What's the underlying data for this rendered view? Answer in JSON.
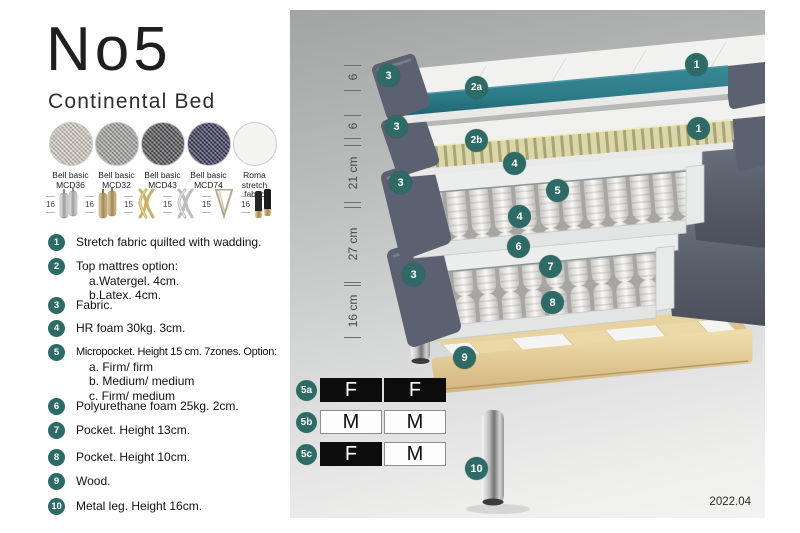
{
  "title": "No5",
  "subtitle": "Continental Bed",
  "fabrics": [
    {
      "line1": "Bell basic",
      "line2": "MCD36",
      "color": "#cfcabf"
    },
    {
      "line1": "Bell basic",
      "line2": "MCD32",
      "color": "#9e9e9c"
    },
    {
      "line1": "Bell basic",
      "line2": "MCD43",
      "color": "#4c4c4e"
    },
    {
      "line1": "Bell basic",
      "line2": "MCD74",
      "color": "#2f3150"
    },
    {
      "line1": "Roma",
      "line2": "stretch fabric",
      "color": "#f4f4f2"
    }
  ],
  "legs": [
    {
      "height": "16",
      "type": "cylinder-silver"
    },
    {
      "height": "16",
      "type": "cylinder-gold"
    },
    {
      "height": "15",
      "type": "twisted-gold"
    },
    {
      "height": "15",
      "type": "twisted-silver"
    },
    {
      "height": "15",
      "type": "hairpin"
    },
    {
      "height": "16",
      "type": "black-gold-tip"
    }
  ],
  "features": [
    {
      "num": "1",
      "text": "Stretch fabric quilted with wadding."
    },
    {
      "num": "2",
      "text": "Top mattres option:",
      "sub": [
        "a.Watergel. 4cm.",
        "b.Latex. 4cm."
      ]
    },
    {
      "num": "3",
      "text": "Fabric."
    },
    {
      "num": "4",
      "text": "HR foam 30kg. 3cm."
    },
    {
      "num": "5",
      "text": "Micropocket. Height 15 cm. 7zones. Option:",
      "sub": [
        "a. Firm/ firm",
        "b. Medium/ medium",
        "c. Firm/ medium"
      ]
    },
    {
      "num": "6",
      "text": "Polyurethane foam 25kg. 2cm."
    },
    {
      "num": "7",
      "text": "Pocket. Height 13cm."
    },
    {
      "num": "8",
      "text": "Pocket. Height 10cm."
    },
    {
      "num": "9",
      "text": "Wood."
    },
    {
      "num": "10",
      "text": "Metal leg. Height 16cm."
    }
  ],
  "diagram": {
    "dimensions": [
      {
        "label": "6"
      },
      {
        "label": "6"
      },
      {
        "label": "21 cm"
      },
      {
        "label": "27 cm"
      },
      {
        "label": "16 cm"
      }
    ],
    "badges": {
      "top1": "1",
      "topper_core": "2a",
      "cover_top": "3",
      "mid1": "1",
      "latex_core": "2b",
      "cover_mid": "3",
      "hr_foam_top": "4",
      "cover_c": "3",
      "micropocket": "5",
      "hr_foam_bottom": "4",
      "pu_foam": "6",
      "cover_d": "3",
      "pocket13": "7",
      "pocket10": "8",
      "wood": "9",
      "leg": "10"
    },
    "table": {
      "rows": [
        {
          "id": "5a",
          "cells": [
            {
              "label": "F",
              "tone": "dark"
            },
            {
              "label": "F",
              "tone": "dark"
            }
          ]
        },
        {
          "id": "5b",
          "cells": [
            {
              "label": "M",
              "tone": "light"
            },
            {
              "label": "M",
              "tone": "light"
            }
          ]
        },
        {
          "id": "5c",
          "cells": [
            {
              "label": "F",
              "tone": "dark"
            },
            {
              "label": "M",
              "tone": "light"
            }
          ]
        }
      ]
    },
    "version": "2022.04"
  },
  "colors": {
    "badge_teal": "#2e6b66",
    "topper_teal": "#2d7a88",
    "latex_beige": "#dcd7a9",
    "fabric_gray": "#5b6170",
    "wood_tan": "#e6cf9d"
  }
}
